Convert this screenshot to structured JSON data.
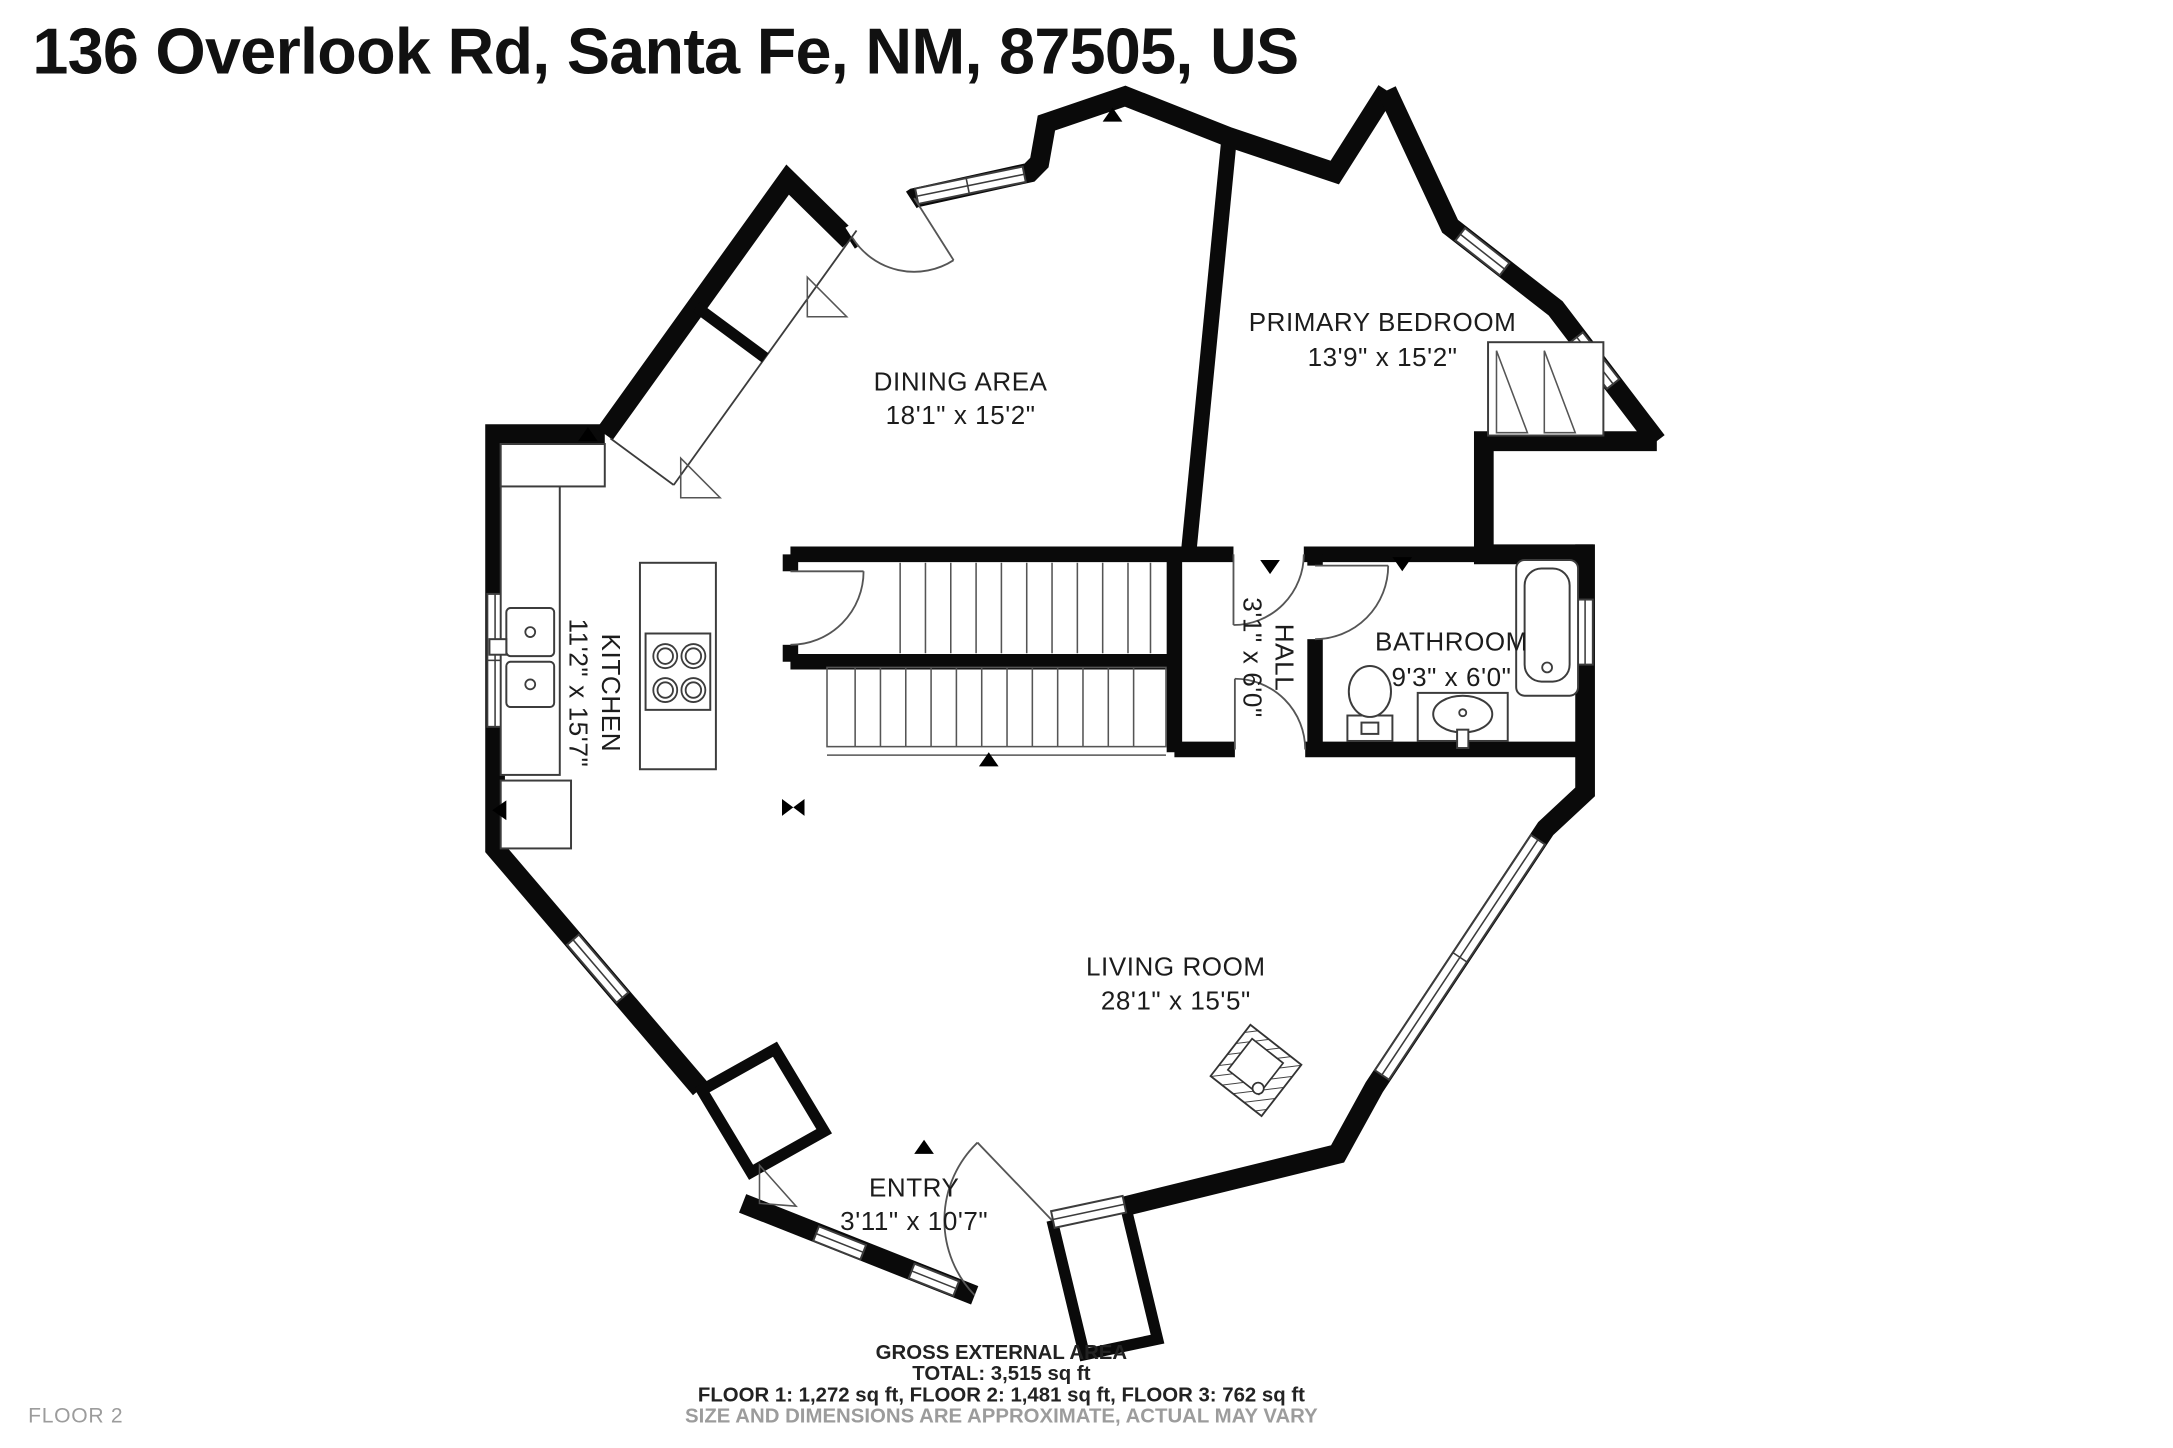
{
  "title": "136 Overlook Rd, Santa Fe, NM, 87505, US",
  "floor_label": "FLOOR 2",
  "rooms": {
    "dining_area": {
      "name": "DINING AREA",
      "dims": "18'1\" x 15'2\""
    },
    "primary_bedroom": {
      "name": "PRIMARY BEDROOM",
      "dims": "13'9\" x 15'2\""
    },
    "kitchen": {
      "name": "KITCHEN",
      "dims": "11'2\" x 15'7\""
    },
    "hall": {
      "name": "HALL",
      "dims": "3'1\" x 6'0\""
    },
    "bathroom": {
      "name": "BATHROOM",
      "dims": "9'3\" x 6'0\""
    },
    "living_room": {
      "name": "LIVING ROOM",
      "dims": "28'1\" x 15'5\""
    },
    "entry": {
      "name": "ENTRY",
      "dims": "3'11\" x 10'7\""
    }
  },
  "footer": {
    "line1": "GROSS EXTERNAL AREA",
    "line2": "TOTAL: 3,515 sq ft",
    "line3": "FLOOR 1: 1,272 sq ft, FLOOR 2: 1,481 sq ft, FLOOR 3: 762 sq ft",
    "line4": "SIZE AND DIMENSIONS ARE APPROXIMATE, ACTUAL MAY VARY"
  },
  "colors": {
    "wall": "#0a0a0a",
    "line": "#3c3c3c",
    "muted": "#9c9c9c",
    "text": "#1c1c1c"
  }
}
